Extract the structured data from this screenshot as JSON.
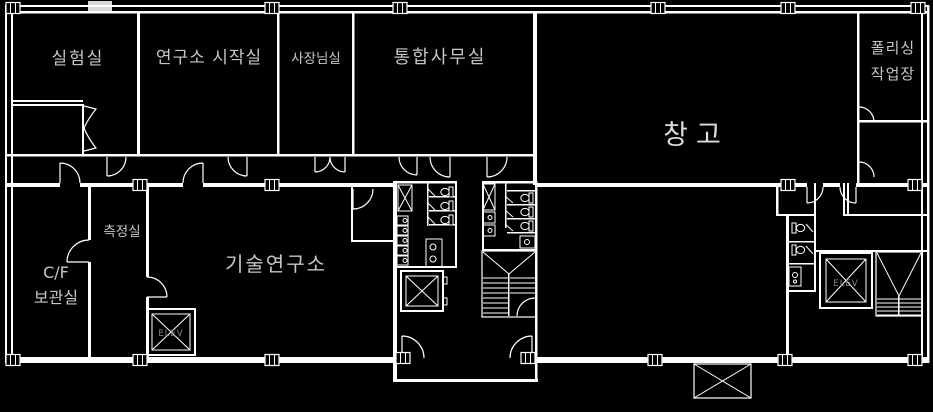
{
  "plan": {
    "background": "#000000",
    "line_color": "#ffffff",
    "label_color": "#c6c6c6",
    "dim_label_color": "#8a8a8a",
    "rooms": [
      {
        "id": "lab",
        "label": "실험실"
      },
      {
        "id": "research-start-room",
        "label": "연구소 시작실"
      },
      {
        "id": "president-office",
        "label": "사장님실"
      },
      {
        "id": "integrated-office",
        "label": "통합사무실"
      },
      {
        "id": "warehouse",
        "label": "창고"
      },
      {
        "id": "polishing-workshop",
        "label_line1": "폴리싱",
        "label_line2": "작업장"
      },
      {
        "id": "measurement-room",
        "label": "측정실"
      },
      {
        "id": "cf-storage",
        "label_line1": "C/F",
        "label_line2": "보관실"
      },
      {
        "id": "tech-research-center",
        "label": "기술연구소"
      }
    ],
    "elevators": [
      {
        "id": "elevator-left-wing",
        "label": "ELEV"
      },
      {
        "id": "elevator-right-core",
        "label": "ELEV"
      }
    ]
  }
}
